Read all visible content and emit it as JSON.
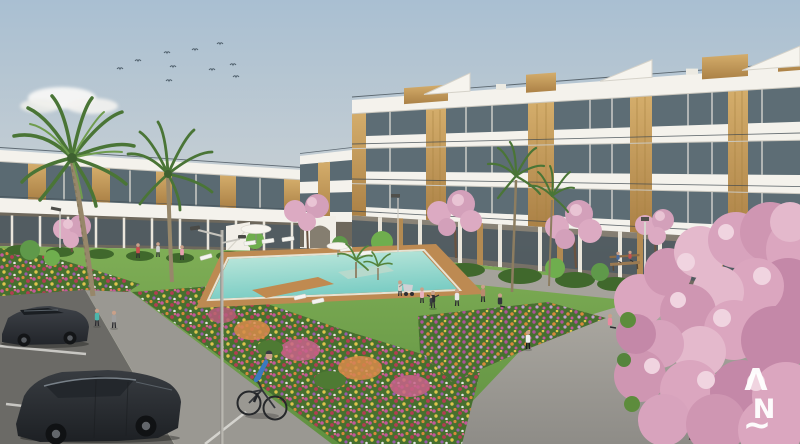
{
  "scene": {
    "title": "Residential complex exterior architectural render",
    "watermark": {
      "top": "Λ",
      "middle": "N",
      "bottom": "~"
    },
    "palette": {
      "sky_top": "#a9bfd2",
      "sky_horizon": "#e9e4da",
      "facade_white": "#f4f2ec",
      "window_glass": "#5d6d75",
      "wood_accent": "#c9a25e",
      "lawn_green": "#6f9d49",
      "pool_water": "#8fd4c8",
      "pool_deck_wood": "#bd8a52",
      "path_gray": "#9d9b95",
      "asphalt": "#6b6a66",
      "blossom_pink": "#dba6bf",
      "watermark_color": "#ffffff"
    },
    "counts": {
      "birds": 10,
      "palm_trees": 6,
      "cherry_blossom_trees": 6,
      "cars": 2,
      "people": 18,
      "sun_loungers": 8,
      "street_lamps": 4,
      "benches": 1,
      "parasols": 2
    },
    "elements": [
      "three-story white apartment buildings with wood panels and glass balconies",
      "two-story side wing",
      "communal swimming pool with wooden deck",
      "garden lawn with flower beds",
      "palm trees",
      "pink cherry blossom trees",
      "parking lot with two dark cars",
      "pedestrian walkway",
      "cyclist",
      "people exercising",
      "sun loungers and parasols",
      "street lamps",
      "bench"
    ]
  }
}
